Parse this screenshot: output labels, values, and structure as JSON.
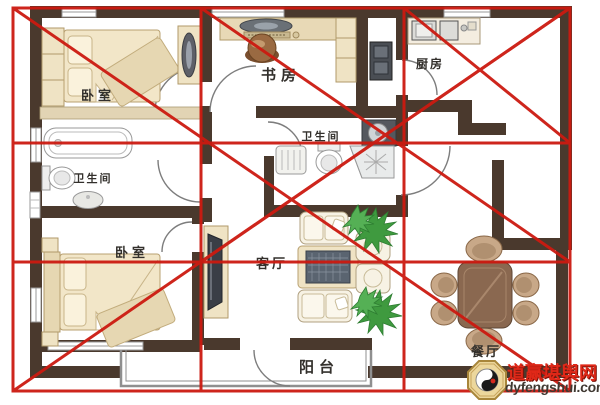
{
  "floorplan": {
    "rooms": [
      {
        "id": "bedroom-1",
        "label": "卧室"
      },
      {
        "id": "bathroom-1",
        "label": "卫生间"
      },
      {
        "id": "bedroom-2",
        "label": "卧室"
      },
      {
        "id": "study",
        "label": "书房"
      },
      {
        "id": "bathroom-2",
        "label": "卫生间"
      },
      {
        "id": "kitchen",
        "label": "厨房"
      },
      {
        "id": "living-room",
        "label": "客厅"
      },
      {
        "id": "balcony",
        "label": "阳台"
      },
      {
        "id": "dining-room",
        "label": "餐厅"
      }
    ],
    "colors": {
      "wall": "#4a392d",
      "furniture_beige": "#efe3c4",
      "annotation_red": "#cc1a10",
      "plant_green": "#3f9a3f"
    }
  },
  "annotation": {
    "style": "red grid and X cross lines over entire plan"
  },
  "watermark": {
    "badge_icon": "bagua-taiji-icon",
    "site_name": "道赢堪舆网",
    "site_url": "dyfengshui.com",
    "name_color": "#e02818",
    "url_color": "#3f3831"
  }
}
